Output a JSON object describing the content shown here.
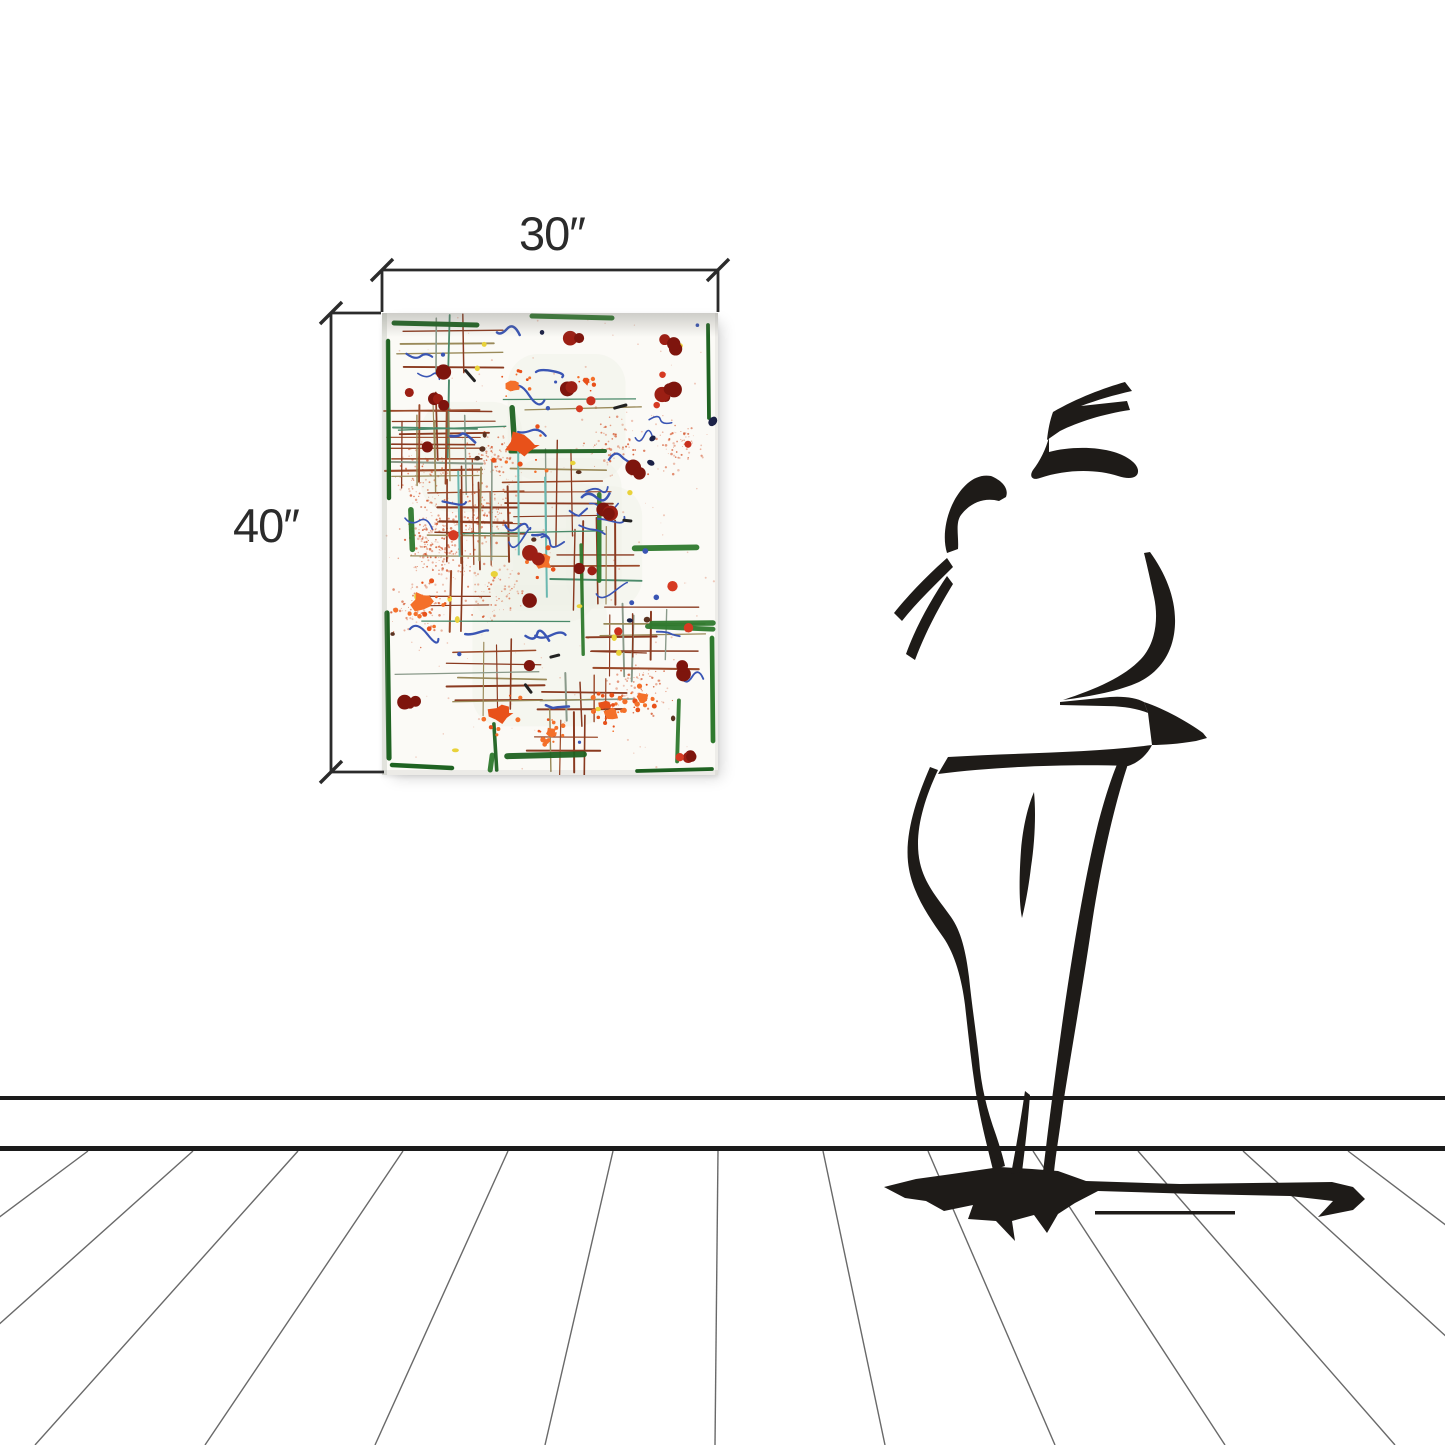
{
  "artwork_mockup": {
    "width_label": "30″",
    "height_label": "40″"
  },
  "icons": {
    "viewer_figure": "person-silhouette",
    "viewer_shadow": "cast-shadow",
    "dimension_ticks": "slash-tick-marks"
  },
  "colors": {
    "wall": "#ffffff",
    "ink": "#1e1b18",
    "dimension": "#2b2b2b",
    "baseboard": "#1b1b1b",
    "plank_line": "#4f4f4f",
    "canvas_background": "#fbfaf6"
  },
  "painting_palette": {
    "tint": "#edf1e7",
    "speckle": "#d4572e",
    "hatch": [
      "#8a3a20",
      "#9b4a2a",
      "#9a8a5a",
      "#8a9a8a",
      "#4a8a6a"
    ],
    "green": [
      "#2f7a2e",
      "#1f6322"
    ],
    "teal": "#6ab8b0",
    "blue": "#3a55b4",
    "navy": "#1b2147",
    "yellow": "#e9d23a",
    "brown": "#5a3220",
    "dark": "#222222",
    "orange": [
      "#f4702a",
      "#e8511a"
    ],
    "red_dark": [
      "#9c1f14",
      "#7e150d"
    ],
    "red_bright": [
      "#c8301d",
      "#d63a22"
    ]
  }
}
